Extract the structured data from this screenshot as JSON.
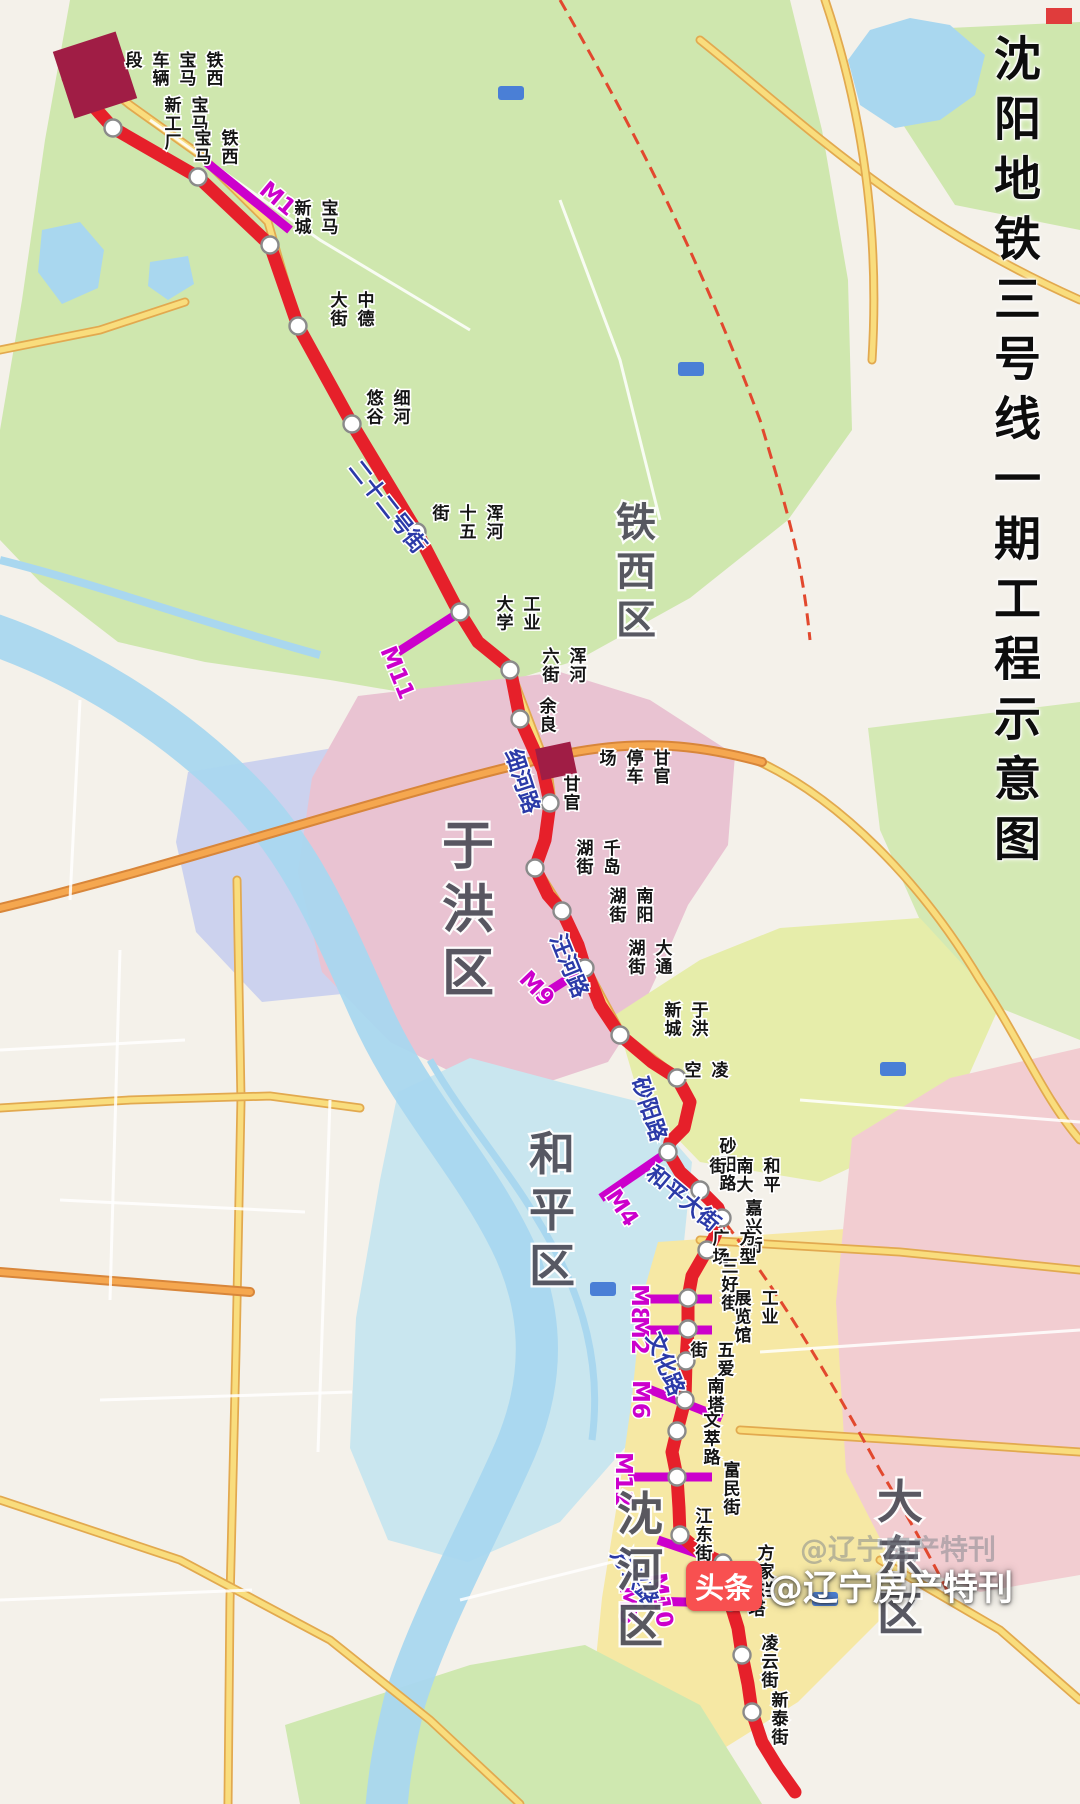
{
  "title": "沈阳地铁三号线一期工程示意图",
  "watermark": {
    "brand": "头条",
    "handle": "@辽宁房产特刊"
  },
  "colors": {
    "line_red": "#e6202a",
    "transfer_magenta": "#cc00cc",
    "station_fill": "#ffffff",
    "station_stroke": "#8a8a8a",
    "depot_red": "#a01d45",
    "road_label_blue": "#2b3aa8",
    "district_gray": "#51515c"
  },
  "line": {
    "name": "地铁三号线一期",
    "station_count": 30
  },
  "districts": [
    {
      "name": "铁西区",
      "x": 636,
      "y": 496,
      "size": 40
    },
    {
      "name": "于洪区",
      "x": 468,
      "y": 812,
      "size": 52
    },
    {
      "name": "和平区",
      "x": 552,
      "y": 1124,
      "size": 46
    },
    {
      "name": "沈河区",
      "x": 640,
      "y": 1484,
      "size": 46
    },
    {
      "name": "大东区",
      "x": 900,
      "y": 1472,
      "size": 46
    }
  ],
  "stations": [
    {
      "name": "宝马新工厂",
      "x": 113,
      "y": 128,
      "lx": 200,
      "ly": 95,
      "cols": [
        "宝马",
        "新工厂"
      ]
    },
    {
      "name": "铁西宝马",
      "x": 198,
      "y": 177,
      "lx": 230,
      "ly": 128,
      "cols": [
        "铁西",
        "宝马"
      ]
    },
    {
      "name": "宝马新城",
      "x": 270,
      "y": 245,
      "lx": 330,
      "ly": 198,
      "cols": [
        "宝马",
        "新城"
      ],
      "transfer": "M1"
    },
    {
      "name": "中德大街",
      "x": 298,
      "y": 326,
      "lx": 366,
      "ly": 290,
      "cols": [
        "中德",
        "大街"
      ]
    },
    {
      "name": "细河悠谷",
      "x": 352,
      "y": 424,
      "lx": 402,
      "ly": 388,
      "cols": [
        "细河",
        "悠谷"
      ]
    },
    {
      "name": "浑河十五街",
      "x": 417,
      "y": 532,
      "lx": 495,
      "ly": 503,
      "cols": [
        "浑河",
        "十五",
        "街"
      ]
    },
    {
      "name": "工业大学",
      "x": 460,
      "y": 612,
      "lx": 532,
      "ly": 594,
      "cols": [
        "工业",
        "大学"
      ],
      "transfer": "M11"
    },
    {
      "name": "浑河六街",
      "x": 510,
      "y": 670,
      "lx": 578,
      "ly": 646,
      "cols": [
        "浑河",
        "六街"
      ]
    },
    {
      "name": "余良",
      "x": 520,
      "y": 719,
      "lx": 548,
      "ly": 696
    },
    {
      "name": "甘官",
      "x": 550,
      "y": 803,
      "lx": 572,
      "ly": 774
    },
    {
      "name": "千岛湖街",
      "x": 535,
      "y": 868,
      "lx": 612,
      "ly": 838,
      "cols": [
        "千岛",
        "湖街"
      ]
    },
    {
      "name": "南阳湖街",
      "x": 562,
      "y": 911,
      "lx": 645,
      "ly": 886,
      "cols": [
        "南阳",
        "湖街"
      ]
    },
    {
      "name": "大通湖街",
      "x": 585,
      "y": 968,
      "lx": 664,
      "ly": 938,
      "cols": [
        "大通",
        "湖街"
      ],
      "transfer": "M9"
    },
    {
      "name": "于洪新城",
      "x": 620,
      "y": 1035,
      "lx": 700,
      "ly": 1000,
      "cols": [
        "于洪",
        "新城"
      ]
    },
    {
      "name": "凌空",
      "x": 677,
      "y": 1078,
      "lx": 720,
      "ly": 1060,
      "cols": [
        "凌",
        "空"
      ]
    },
    {
      "name": "砂阳路",
      "x": 668,
      "y": 1152,
      "lx": 728,
      "ly": 1136
    },
    {
      "name": "和平南大街",
      "x": 700,
      "y": 1190,
      "lx": 772,
      "ly": 1156,
      "cols": [
        "和平",
        "南大",
        "街"
      ]
    },
    {
      "name": "嘉兴街",
      "x": 722,
      "y": 1218,
      "lx": 754,
      "ly": 1198
    },
    {
      "name": "方型广场",
      "x": 707,
      "y": 1250,
      "lx": 748,
      "ly": 1228,
      "cols": [
        "方型",
        "广场"
      ]
    },
    {
      "name": "三好街",
      "x": 688,
      "y": 1298,
      "lx": 730,
      "ly": 1256,
      "transfer": "M8"
    },
    {
      "name": "工业展览馆",
      "x": 688,
      "y": 1329,
      "lx": 770,
      "ly": 1288,
      "cols": [
        "工业",
        "展览馆"
      ],
      "transfer": "M2"
    },
    {
      "name": "五爱街",
      "x": 686,
      "y": 1361,
      "lx": 726,
      "ly": 1340,
      "cols": [
        "五爱",
        "街"
      ]
    },
    {
      "name": "南塔",
      "x": 685,
      "y": 1400,
      "lx": 716,
      "ly": 1376,
      "transfer": "M6"
    },
    {
      "name": "文萃路",
      "x": 677,
      "y": 1431,
      "lx": 712,
      "ly": 1410
    },
    {
      "name": "富民街",
      "x": 677,
      "y": 1477,
      "lx": 732,
      "ly": 1460,
      "transfer": "M12"
    },
    {
      "name": "江东街",
      "x": 680,
      "y": 1535,
      "lx": 704,
      "ly": 1506
    },
    {
      "name": "方家栏",
      "x": 723,
      "y": 1563,
      "lx": 766,
      "ly": 1543,
      "transfer": "M10"
    },
    {
      "name": "东塔",
      "x": 730,
      "y": 1602,
      "lx": 757,
      "ly": 1580,
      "transfer": "M5"
    },
    {
      "name": "凌云街",
      "x": 742,
      "y": 1655,
      "lx": 770,
      "ly": 1633
    },
    {
      "name": "新泰街",
      "x": 752,
      "y": 1712,
      "lx": 780,
      "ly": 1690
    }
  ],
  "transfers": [
    {
      "label": "M1",
      "x1": 206,
      "y1": 162,
      "x2": 290,
      "y2": 230,
      "lx": 258,
      "ly": 192,
      "rot": 40
    },
    {
      "label": "M11",
      "x1": 460,
      "y1": 612,
      "x2": 398,
      "y2": 652,
      "lx": 380,
      "ly": 650,
      "rot": 68
    },
    {
      "label": "M9",
      "x1": 585,
      "y1": 968,
      "x2": 538,
      "y2": 998,
      "lx": 518,
      "ly": 980,
      "rot": 46
    },
    {
      "label": "M4",
      "x1": 668,
      "y1": 1152,
      "x2": 601,
      "y2": 1198,
      "lx": 605,
      "ly": 1196,
      "rot": 56
    },
    {
      "label": "M8",
      "x1": 645,
      "y1": 1299,
      "x2": 712,
      "y2": 1299,
      "lx": 632,
      "ly": 1284,
      "rot": 90
    },
    {
      "label": "M2",
      "x1": 645,
      "y1": 1330,
      "x2": 712,
      "y2": 1330,
      "lx": 632,
      "ly": 1316,
      "rot": 90
    },
    {
      "label": "M6",
      "x1": 646,
      "y1": 1388,
      "x2": 722,
      "y2": 1418,
      "lx": 633,
      "ly": 1380,
      "rot": 90
    },
    {
      "label": "M12",
      "x1": 628,
      "y1": 1477,
      "x2": 712,
      "y2": 1477,
      "lx": 616,
      "ly": 1452,
      "rot": 90
    },
    {
      "label": "M10",
      "x1": 658,
      "y1": 1540,
      "x2": 722,
      "y2": 1562,
      "lx": 650,
      "ly": 1574,
      "rot": 82
    },
    {
      "label": "M5",
      "x1": 646,
      "y1": 1601,
      "x2": 726,
      "y2": 1603,
      "lx": 620,
      "ly": 1586,
      "rot": 90
    }
  ],
  "depots": [
    {
      "name": "铁西宝马车辆段",
      "cols": [
        "铁西",
        "宝马",
        "车辆",
        "段"
      ],
      "lx": 215,
      "ly": 50,
      "block": {
        "x": 62,
        "y": 40,
        "w": 66,
        "h": 70,
        "rot": -18
      }
    },
    {
      "name": "甘官停车场",
      "cols": [
        "甘官",
        "停车",
        "场"
      ],
      "lx": 662,
      "ly": 748,
      "block": {
        "x": 538,
        "y": 745,
        "w": 36,
        "h": 32,
        "rot": -12
      }
    }
  ],
  "road_labels": [
    {
      "name": "二十二号街",
      "x": 348,
      "y": 468,
      "rot": 52
    },
    {
      "name": "细河路",
      "x": 505,
      "y": 752,
      "rot": 72
    },
    {
      "name": "汪河路",
      "x": 550,
      "y": 938,
      "rot": 68
    },
    {
      "name": "砂阳路",
      "x": 632,
      "y": 1080,
      "rot": 72
    },
    {
      "name": "和平大街",
      "x": 645,
      "y": 1176,
      "rot": 40
    },
    {
      "name": "文化路",
      "x": 646,
      "y": 1336,
      "rot": 68
    },
    {
      "name": "方兴路",
      "x": 610,
      "y": 1554,
      "rot": 56
    }
  ]
}
